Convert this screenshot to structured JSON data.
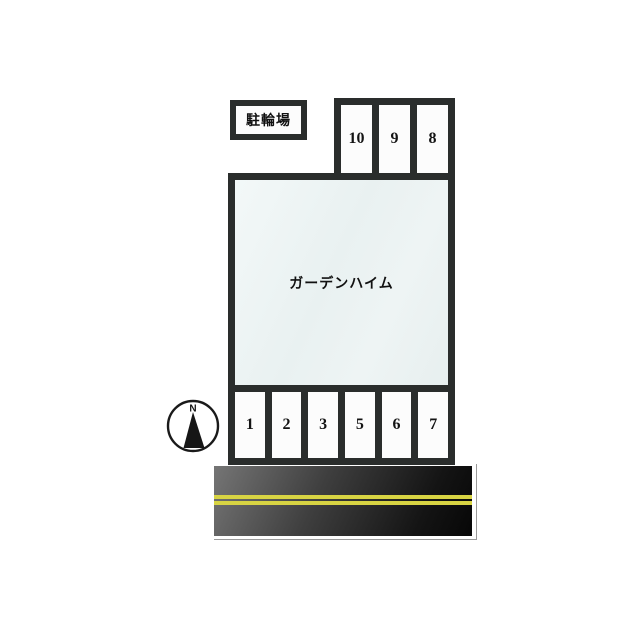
{
  "diagram": {
    "bike_parking_label": "駐輪場",
    "building_label": "ガーデンハイム",
    "compass_north_label": "N",
    "top_stalls": [
      "10",
      "9",
      "8"
    ],
    "bottom_stalls": [
      "1",
      "2",
      "3",
      "5",
      "6",
      "7"
    ],
    "colors": {
      "outline": "#2a2d2c",
      "building_fill": "#ebf2f2",
      "stall_fill": "#fcfcfc",
      "road_gray_light": "#757575",
      "road_black": "#070707",
      "road_edge_white": "#ffffff",
      "center_line_yellow": "#d8d443",
      "background": "#ffffff",
      "text": "#111111"
    }
  }
}
